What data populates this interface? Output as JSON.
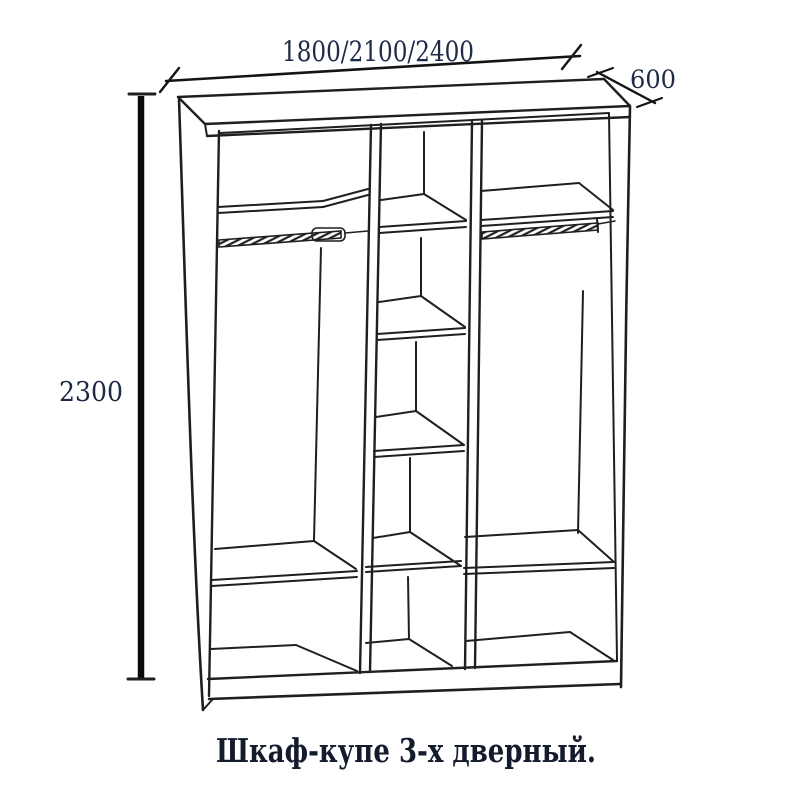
{
  "dimensions": {
    "width_label": "1800/2100/2400",
    "depth_label": "600",
    "height_label": "2300"
  },
  "caption": "Шкаф-купе 3-х дверный.",
  "drawing": {
    "type": "wardrobe technical line drawing",
    "sections": 3,
    "left_section": {
      "top_shelf": 1,
      "hanging_rail": true,
      "bottom_shelves": 2
    },
    "middle_section": {
      "shelves": 5
    },
    "right_section": {
      "top_shelf": 1,
      "hanging_rail": true,
      "bottom_shelves": 2
    },
    "colors": {
      "line": "#1f1f1f",
      "dimension_text": "#1e2a47",
      "caption_text": "#141b2d",
      "background": "#ffffff"
    }
  }
}
